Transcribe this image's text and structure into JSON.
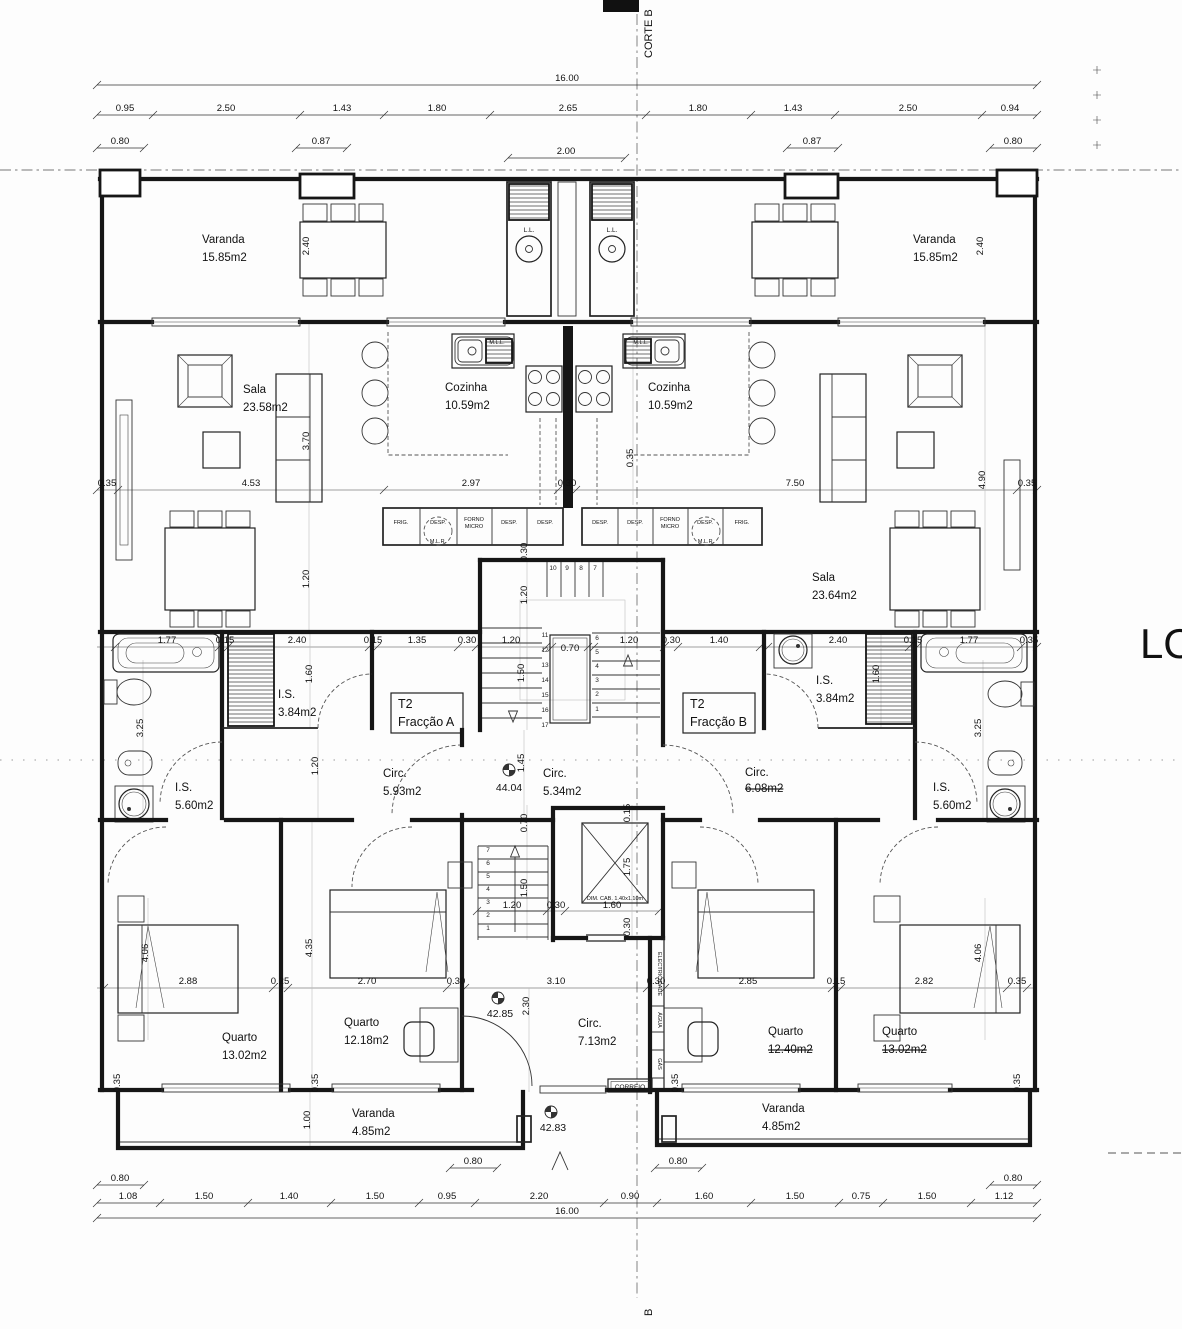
{
  "section": {
    "top_label": "CORTE B",
    "bottom_label": "B",
    "right_text": "LO"
  },
  "levels": {
    "upper": "44.04",
    "ground_hall": "42.85",
    "entry": "42.83"
  },
  "fractions": {
    "a_line1": "T2",
    "a_line2": "Fracção A",
    "b_line1": "T2",
    "b_line2": "Fracção B"
  },
  "rooms": {
    "varanda_tl": {
      "name": "Varanda",
      "area": "15.85m2"
    },
    "varanda_tr": {
      "name": "Varanda",
      "area": "15.85m2"
    },
    "sala_l": {
      "name": "Sala",
      "area": "23.58m2"
    },
    "sala_r": {
      "name": "Sala",
      "area": "23.64m2"
    },
    "coz_l": {
      "name": "Cozinha",
      "area": "10.59m2"
    },
    "coz_r": {
      "name": "Cozinha",
      "area": "10.59m2"
    },
    "is34_l": {
      "name": "I.S.",
      "area": "3.84m2"
    },
    "is34_r": {
      "name": "I.S.",
      "area": "3.84m2"
    },
    "is56_l": {
      "name": "I.S.",
      "area": "5.60m2"
    },
    "is56_r": {
      "name": "I.S.",
      "area": "5.60m2"
    },
    "circ_a": {
      "name": "Circ.",
      "area": "5.93m2"
    },
    "circ_hall": {
      "name": "Circ.",
      "area": "5.34m2"
    },
    "circ_b": {
      "name": "Circ.",
      "area": "6.08m2"
    },
    "circ_entry": {
      "name": "Circ.",
      "area": "7.13m2"
    },
    "q1": {
      "name": "Quarto",
      "area": "13.02m2"
    },
    "q2": {
      "name": "Quarto",
      "area": "12.18m2"
    },
    "q3": {
      "name": "Quarto",
      "area": "12.40m2"
    },
    "q4": {
      "name": "Quarto",
      "area": "13.02m2"
    },
    "var_bl": {
      "name": "Varanda",
      "area": "4.85m2"
    },
    "var_br": {
      "name": "Varanda",
      "area": "4.85m2"
    }
  },
  "labels": {
    "ll": "L.L.",
    "mll": "M.L.L.",
    "mlr": "M.L.R.",
    "correio": "CORREIO",
    "electricidade": "ELECTRICIDADE",
    "agua": "ÁGUA",
    "gas": "GÁS",
    "lift_cab": "DIM. CAB. 1.40x1.10m"
  },
  "appliances": {
    "left": {
      "a0": "FRIG.",
      "a1": "DESP.",
      "a2a": "FORNO",
      "a2b": "MICRO",
      "a3": "DESP.",
      "a4": "DESP."
    },
    "right": {
      "a0": "DESP.",
      "a1": "DESP.",
      "a2a": "FORNO",
      "a2b": "MICRO",
      "a3": "DESP.",
      "a4": "FRIG."
    }
  },
  "stairs": {
    "flight_top": [
      "10",
      "9",
      "8",
      "7"
    ],
    "flight_left": [
      "11",
      "12",
      "13",
      "14",
      "15",
      "16",
      "17"
    ],
    "flight_right": [
      "6",
      "5",
      "4",
      "3",
      "2",
      "1"
    ],
    "flight_lower": [
      "7",
      "6",
      "5",
      "4",
      "3",
      "2",
      "1"
    ]
  },
  "dims": {
    "top_total": "16.00",
    "top_chain": [
      "0.95",
      "2.50",
      "1.43",
      "1.80",
      "2.65",
      "1.80",
      "1.43",
      "2.50",
      "0.94"
    ],
    "top_sub": [
      "0.80",
      "0.87",
      "2.00",
      "0.87",
      "0.80"
    ],
    "upper_mid": [
      "0.35",
      "4.53",
      "2.97",
      "0.30",
      "7.50",
      "0.35"
    ],
    "bath_row": [
      "1.77",
      "0.15",
      "2.40",
      "0.15",
      "1.35",
      "0.30",
      "1.20",
      "0.70",
      "1.20",
      "0.30",
      "1.40",
      "2.40",
      "0.15",
      "1.77",
      "0.35"
    ],
    "bed_row": [
      "2.88",
      "0.25",
      "2.70",
      "0.30",
      "3.10",
      "0.30",
      "2.85",
      "0.15",
      "2.82",
      "0.35"
    ],
    "lift_row": [
      "1.20",
      "0.30",
      "1.60"
    ],
    "bottom_sub": [
      "0.80",
      "0.80",
      "0.80",
      "0.80"
    ],
    "bottom_chain": [
      "1.08",
      "1.50",
      "1.40",
      "1.50",
      "0.95",
      "2.20",
      "0.90",
      "1.60",
      "1.50",
      "0.75",
      "1.50",
      "1.12"
    ],
    "bottom_total": "16.00",
    "v": {
      "varanda_l": "2.40",
      "varanda_r": "2.40",
      "entry_width": "0.35",
      "sofa_l": "3.70",
      "sala_r": "4.90",
      "sala_l_low": "1.20",
      "stair_top": "0.30",
      "stair_up": "1.20",
      "stair_mid": "1.50",
      "stair_low": "1.45",
      "ward_l": "1.60",
      "ward_r": "1.60",
      "bath_l": "3.25",
      "bath_r": "3.25",
      "hall_l": "1.20",
      "lift_top": "0.15",
      "lift_up": "0.70",
      "lift_mid": "1.50",
      "lift_cab_h": "1.75",
      "lift_bot": "0.30",
      "q1_h": "4.06",
      "q2_h": "4.35",
      "q4_h": "4.06",
      "hall_entry": "2.30",
      "balc_l": "1.00",
      "w1": "0.35",
      "w2": "0.35",
      "w3": "0.35",
      "w4": "0.35"
    }
  }
}
